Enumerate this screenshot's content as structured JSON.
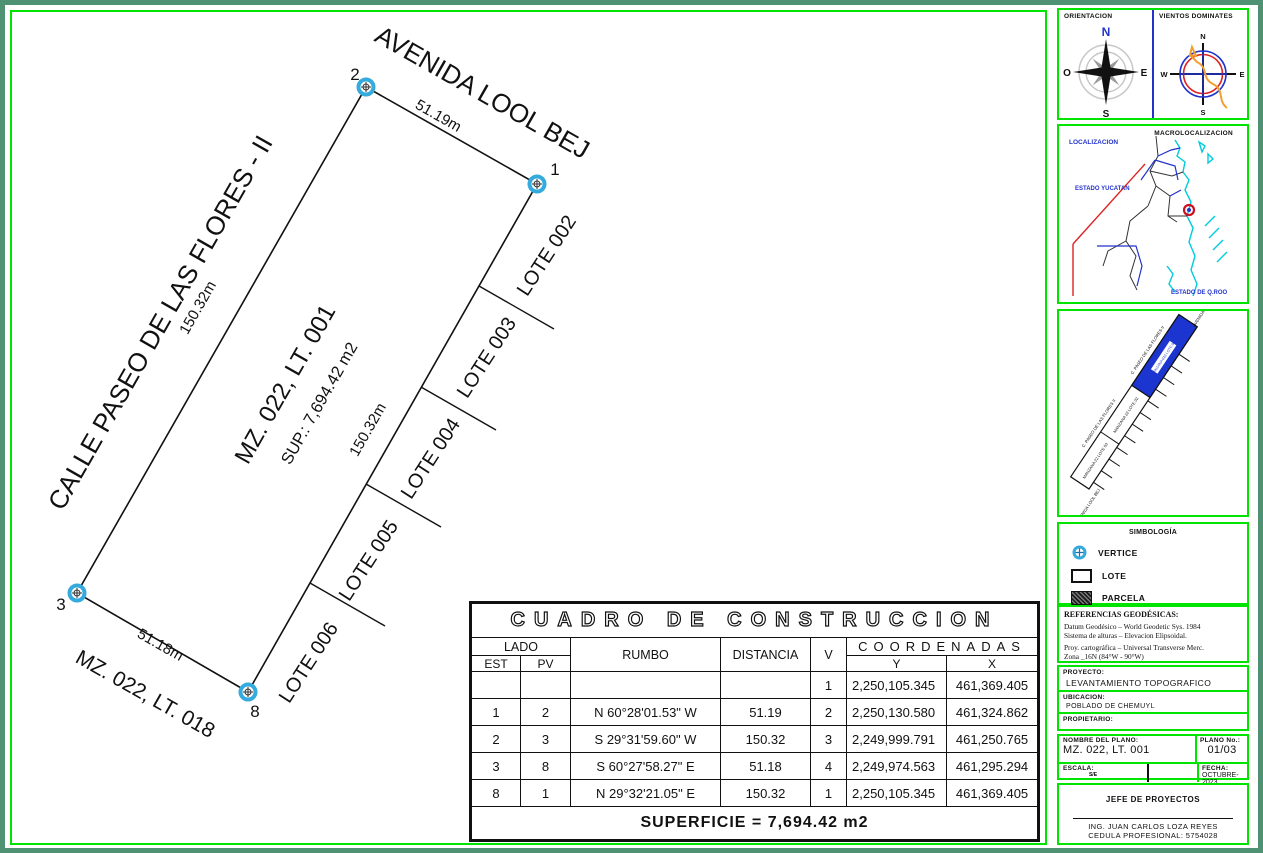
{
  "drawing": {
    "street_top": "AVENIDA LOOL BEJ",
    "street_left": "CALLE PASEO DE LAS FLORES - II",
    "neighbor_block": "MZ. 022, LT. 018",
    "parcel_name": "MZ. 022, LT. 001",
    "parcel_area": "SUP.: 7,694.42 m2",
    "dim_top": "51.19m",
    "dim_left": "150.32m",
    "dim_right": "150.32m",
    "dim_bottom": "51.18m",
    "lots": {
      "l2": "LOTE 002",
      "l3": "LOTE 003",
      "l4": "LOTE 004",
      "l5": "LOTE 005",
      "l6": "LOTE 006"
    },
    "vertex_2": "2",
    "vertex_1": "1",
    "vertex_3": "3",
    "vertex_8": "8"
  },
  "table": {
    "title": "CUADRO DE CONSTRUCCION",
    "headers": {
      "lado": "LADO",
      "est": "EST",
      "pv": "PV",
      "rumbo": "RUMBO",
      "distancia": "DISTANCIA",
      "v": "V",
      "coordenadas": "COORDENADAS",
      "y": "Y",
      "x": "X"
    },
    "rows": [
      {
        "est": "",
        "pv": "",
        "rumbo": "",
        "dist": "",
        "v": "1",
        "y": "2,250,105.345",
        "x": "461,369.405"
      },
      {
        "est": "1",
        "pv": "2",
        "rumbo": "N 60°28'01.53\" W",
        "dist": "51.19",
        "v": "2",
        "y": "2,250,130.580",
        "x": "461,324.862"
      },
      {
        "est": "2",
        "pv": "3",
        "rumbo": "S 29°31'59.60\" W",
        "dist": "150.32",
        "v": "3",
        "y": "2,249,999.791",
        "x": "461,250.765"
      },
      {
        "est": "3",
        "pv": "8",
        "rumbo": "S 60°27'58.27\" E",
        "dist": "51.18",
        "v": "4",
        "y": "2,249,974.563",
        "x": "461,295.294"
      },
      {
        "est": "8",
        "pv": "1",
        "rumbo": "N 29°32'21.05\" E",
        "dist": "150.32",
        "v": "1",
        "y": "2,250,105.345",
        "x": "461,369.405"
      }
    ],
    "superficie": "SUPERFICIE = 7,694.42 m2"
  },
  "sidebar": {
    "orientacion": {
      "title": "ORIENTACION",
      "n": "N",
      "s": "S",
      "e": "E",
      "o": "O"
    },
    "vientos": {
      "title": "VIENTOS DOMINATES",
      "n": "N",
      "s": "S",
      "e": "E",
      "w": "W"
    },
    "macro": {
      "title": "MACROLOCALIZACION",
      "localizacion": "LOCALIZACION",
      "yucatan": "ESTADO YUCATAN",
      "qroo": "ESTADO DE Q.ROO"
    },
    "micro": {
      "avenida_top": "AVENIDA LOOL BEJ",
      "avenida_bottom": "AVENIDA LOOL BEJ",
      "calle_1": "C. PASEO DE LAS FLORES II",
      "calle_2": "C. PASEO DE LAS FLORES II",
      "lot_blue": "MANZANA 022 LOTE 001",
      "lot_2": "MANZANA 22 LOTE 02",
      "lot_3": "MANZANA 22 LOTE 03"
    },
    "simbologia": {
      "title": "SIMBOLOGÍA",
      "vertice": "VERTICE",
      "lote": "LOTE",
      "parcela": "PARCELA"
    },
    "referencias": {
      "title": "REFERENCIAS GEODÉSICAS:",
      "line1": "Datum Geodésico – World Geodetic Sys. 1984",
      "line2": "Sistema de alturas – Elevacion Elipsoidal.",
      "line3": "Proy. cartográfica – Universal Transverse Merc.",
      "line4": "Zona _16N  (84°W - 90°W)"
    },
    "proyecto": {
      "label": "PROYECTO:",
      "value": "LEVANTAMIENTO TOPOGRAFICO"
    },
    "ubicacion": {
      "label": "UBICACION:",
      "value": "POBLADO DE CHEMUYL"
    },
    "propietario": {
      "label": "PROPIETARIO:",
      "value": ""
    },
    "plano": {
      "nombre_label": "NOMBRE DEL PLANO:",
      "nombre_value": "MZ. 022, LT. 001",
      "num_label": "PLANO No.:",
      "num_value": "01/03",
      "escala_label": "ESCALA:",
      "escala_value": "S/E",
      "fecha_label": "FECHA:",
      "fecha_value": "OCTUBRE-2023"
    },
    "firma": {
      "title": "JEFE DE PROYECTOS",
      "nombre": "ING. JUAN CARLOS LOZA REYES",
      "cedula": "CEDULA PROFESIONAL: 5754028"
    }
  },
  "colors": {
    "frame_teal": "#4f9173",
    "panel_green": "#00e400",
    "accent_blue": "#2233cc",
    "parcel_blue": "#1c35d1",
    "vertex_cyan": "#35aadc",
    "map_cyan": "#00ccdd",
    "boundary_red": "#dd2222",
    "wind_orange": "#f0a030"
  }
}
